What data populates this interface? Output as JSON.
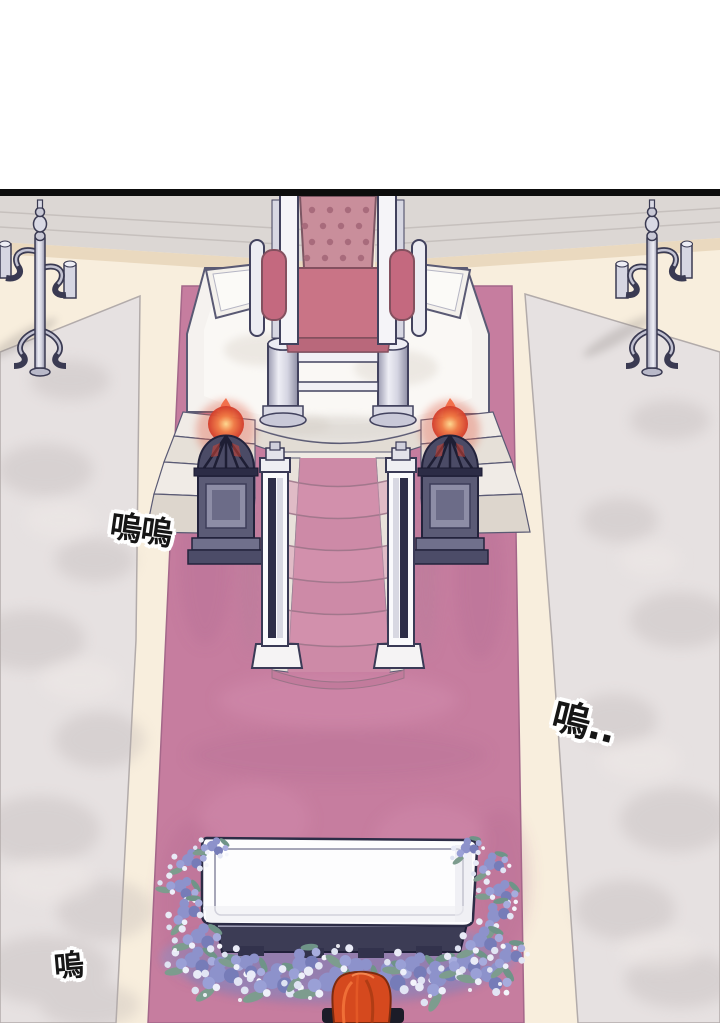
{
  "panel": {
    "alt": "Overhead view of a palace throne hall: empty throne on a white marble dais with carpeted stairs, two lit braziers, tall silver candelabras, and a white coffin wreathed in blue flowers on a rose carpet; a red-haired mourner stands at the bottom edge.",
    "border_color": "#0d0d0d",
    "margin_color": "#ffffff"
  },
  "sfx": {
    "left": {
      "text": "嗚嗚"
    },
    "right": {
      "text": "嗚.."
    },
    "bottom": {
      "text": "嗚"
    }
  },
  "scene": {
    "objects": [
      "throne",
      "dais",
      "staircase",
      "brazier-left",
      "brazier-right",
      "candelabra-left",
      "candelabra-right",
      "red-carpet",
      "coffin",
      "flower-garland",
      "mourner"
    ],
    "colors": {
      "carpet": "#c67d9f",
      "stair_runner": "#cd8aa7",
      "marble_floor": "#e6e1e1",
      "aisle": "#f8eedd",
      "dais_marble": "#f5f2ef",
      "throne_cushion": "#c98e9b",
      "throne_seat": "#c97486",
      "flame": "#e85a3c",
      "brazier": "#5b5b76",
      "coffin": "#fdfdfe",
      "flowers": "#8b90c8",
      "leaves": "#7d9c8e",
      "hair": "#d5491e",
      "outline": "#42425e",
      "sfx_ink": "#161616"
    }
  }
}
